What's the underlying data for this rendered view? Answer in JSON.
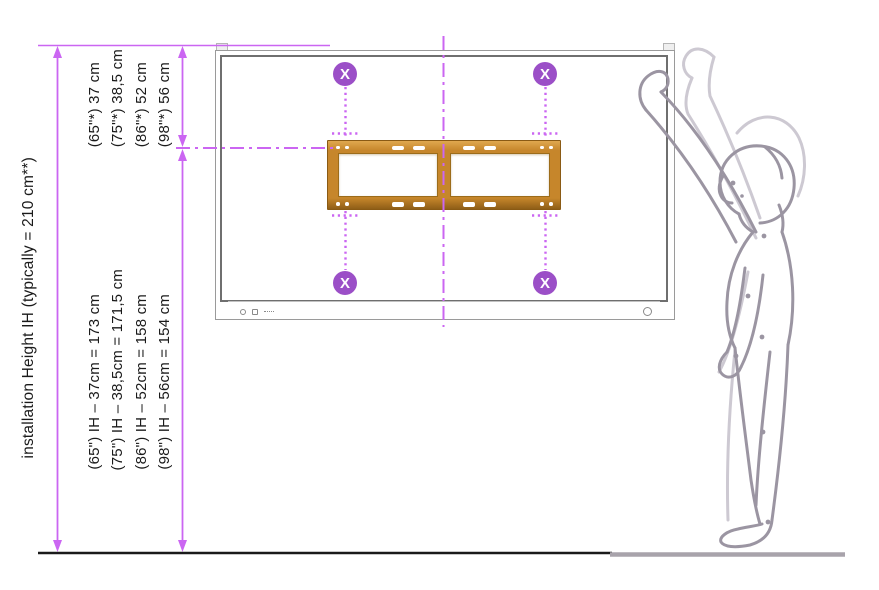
{
  "diagram": {
    "title_hidden": "",
    "installation_height_label": "installation Height IH (typically = 210 cm**)",
    "panel_offsets": [
      "(65\"*) 37 cm",
      "(75\"*) 38,5 cm",
      "(86\"*) 52 cm",
      "(98\"*) 56 cm"
    ],
    "mount_heights": [
      "(65\") IH – 37cm = 173 cm",
      "(75\") IH – 38,5cm = 171,5 cm",
      "(86\") IH – 52cm = 158 cm",
      "(98\") IH – 56cm = 154 cm"
    ],
    "marker_symbol": "X",
    "typical_installation_height_cm": 210,
    "offsets_cm": {
      "65": 37,
      "75": 38.5,
      "86": 52,
      "98": 56
    },
    "resulting_heights_cm": {
      "65": 173,
      "75": 171.5,
      "86": 158,
      "98": 154
    }
  },
  "colors": {
    "dimension_magenta": "#cb66f2",
    "marker_purple": "#9b4fc7",
    "bracket_gold": "#c6862b",
    "person_gray": "#9b95a2",
    "person_ghost_gray": "#cdc9d2",
    "display_frame_gray": "#9a9a9a",
    "floor_black": "#1a1a1a",
    "floor_gray": "#a8a3ab"
  }
}
